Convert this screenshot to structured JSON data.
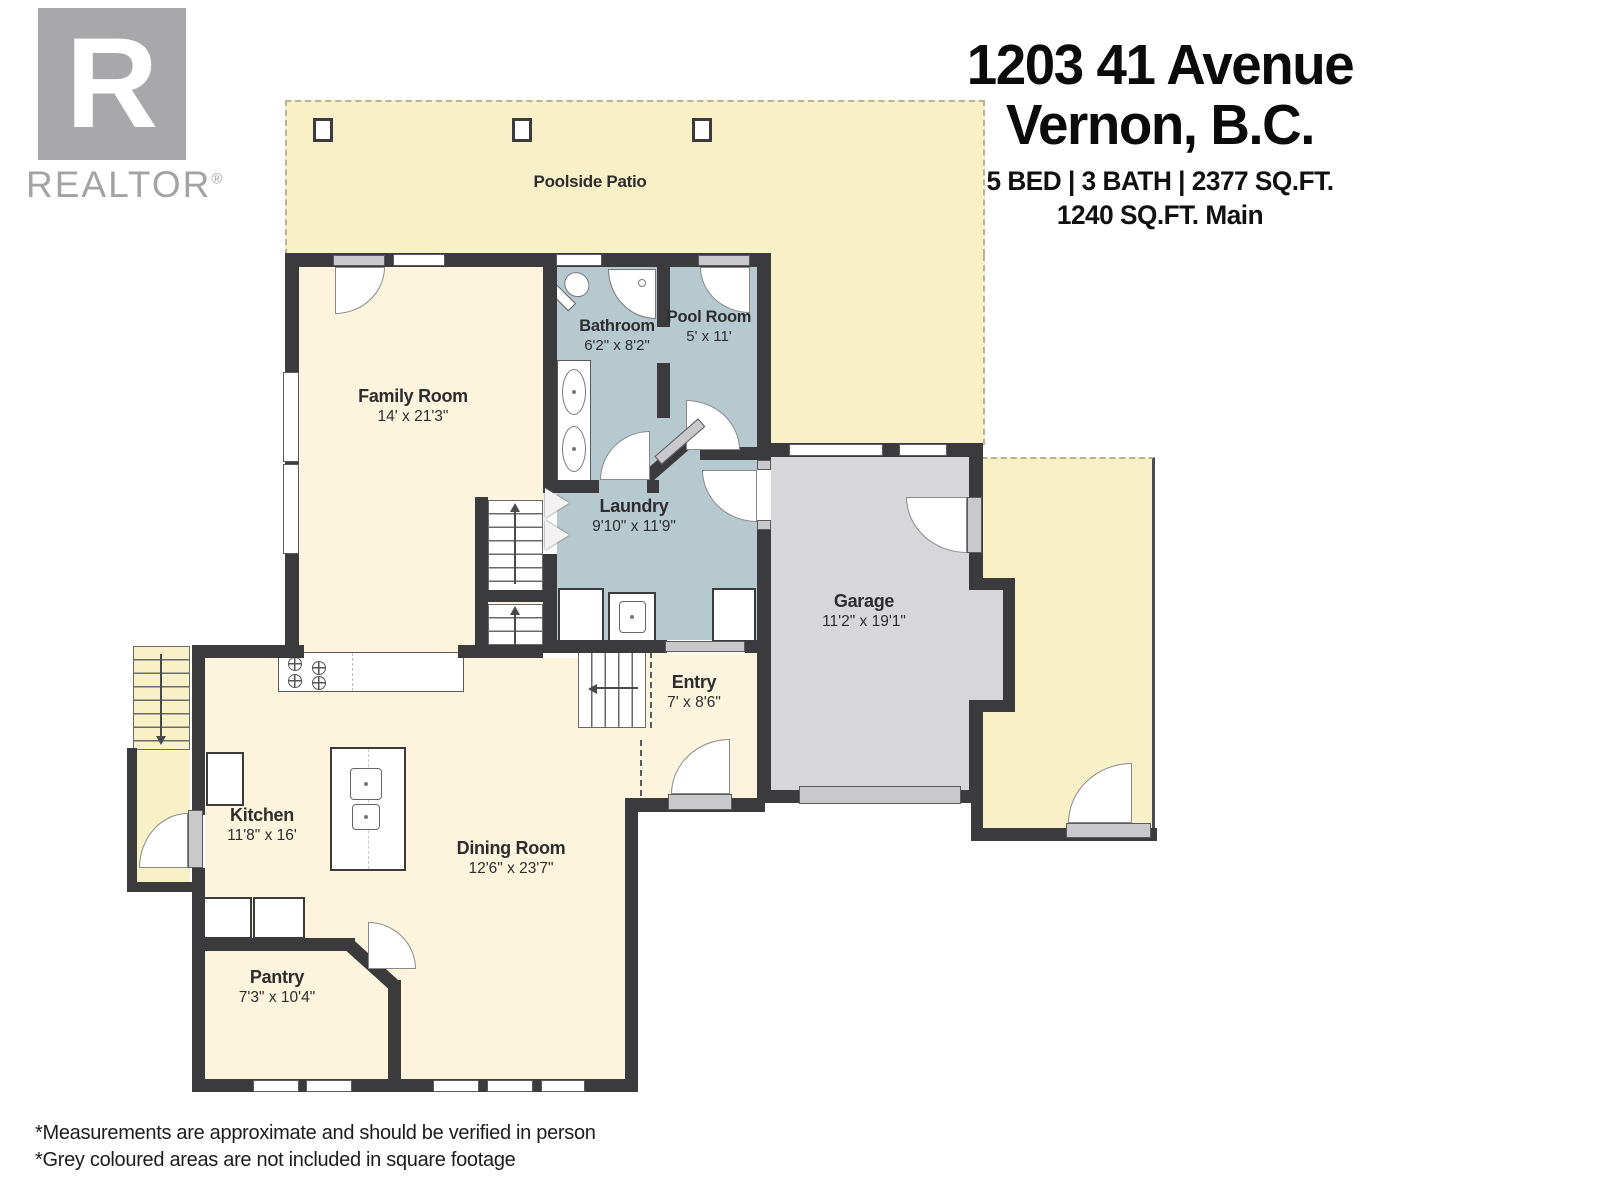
{
  "brand": {
    "logo_letter": "R",
    "brand_name": "REALTOR",
    "registered_mark": "®"
  },
  "header": {
    "address_line1": "1203 41 Avenue",
    "address_line2": "Vernon, B.C.",
    "spec_line1": "5 BED | 3 BATH | 2377 SQ.FT.",
    "spec_line2": "1240 SQ.FT. Main"
  },
  "outdoor": {
    "patio_label": "Poolside Patio"
  },
  "rooms": [
    {
      "name": "Family Room",
      "dims": "14' x 21'3\""
    },
    {
      "name": "Bathroom",
      "dims": "6'2\" x 8'2\""
    },
    {
      "name": "Pool Room",
      "dims": "5' x 11'"
    },
    {
      "name": "Laundry",
      "dims": "9'10\" x 11'9\""
    },
    {
      "name": "Garage",
      "dims": "11'2\" x 19'1\""
    },
    {
      "name": "Entry",
      "dims": "7' x 8'6\""
    },
    {
      "name": "Kitchen",
      "dims": "11'8\" x 16'"
    },
    {
      "name": "Dining Room",
      "dims": "12'6\" x 23'7\""
    },
    {
      "name": "Pantry",
      "dims": "7'3\" x 10'4\""
    }
  ],
  "footnotes": {
    "line1": "*Measurements are approximate and should be verified in person",
    "line2": "*Grey coloured areas are not included in square footage"
  },
  "colors": {
    "interior": "#fcf4dc",
    "outdoor": "#f8f1c8",
    "wet_rooms": "#b6c9ce",
    "garage": "#d7d7d9",
    "walls": "#3b3b3d"
  }
}
